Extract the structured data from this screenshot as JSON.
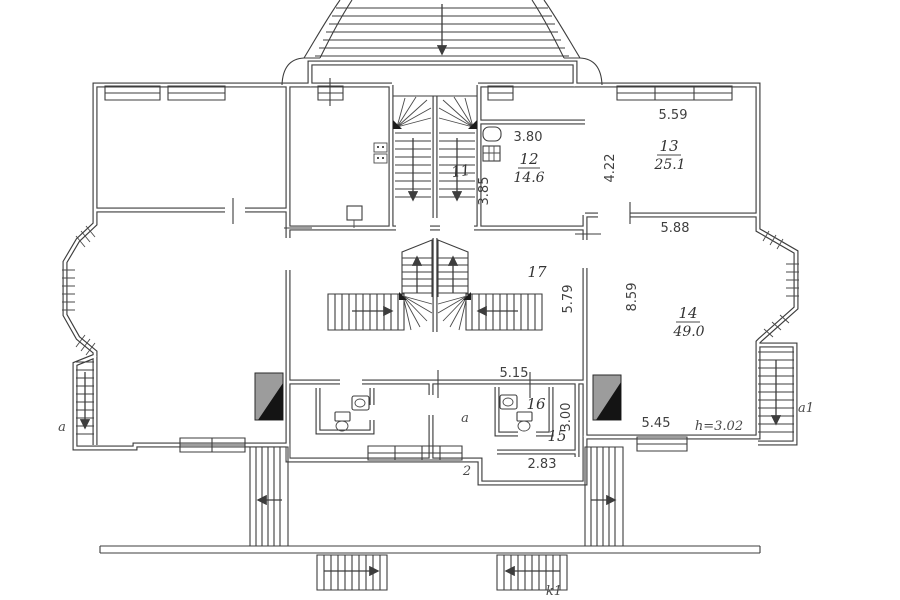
{
  "plan": {
    "type": "architectural floor plan",
    "rooms": {
      "r11": {
        "number": "11"
      },
      "r12": {
        "number": "12",
        "area": "14.6"
      },
      "r13": {
        "number": "13",
        "area": "25.1"
      },
      "r14": {
        "number": "14",
        "area": "49.0"
      },
      "r15": {
        "number": "15"
      },
      "r16": {
        "number": "16"
      },
      "r17": {
        "number": "17"
      }
    },
    "dimensions": {
      "room12_width": "3.80",
      "room12_depth": "3.85",
      "room13_width": "5.59",
      "room13_depth": "4.22",
      "room14_width_top": "5.88",
      "room14_depth": "8.59",
      "hall_depth": "5.79",
      "lower_width": "5.15",
      "room15_depth": "3.00",
      "room15_width": "2.83",
      "room14_width_bottom": "5.45",
      "ceiling_height": "h=3.02"
    },
    "markers": {
      "left_stair": "a",
      "vestibule": "a",
      "right_stair": "a1",
      "section_2": "2",
      "terrace": "k1"
    },
    "colors": {
      "line": "#3d3d3d",
      "paper": "#ffffff",
      "chimney_light": "#9c9c9c",
      "chimney_dark": "#141414"
    }
  }
}
